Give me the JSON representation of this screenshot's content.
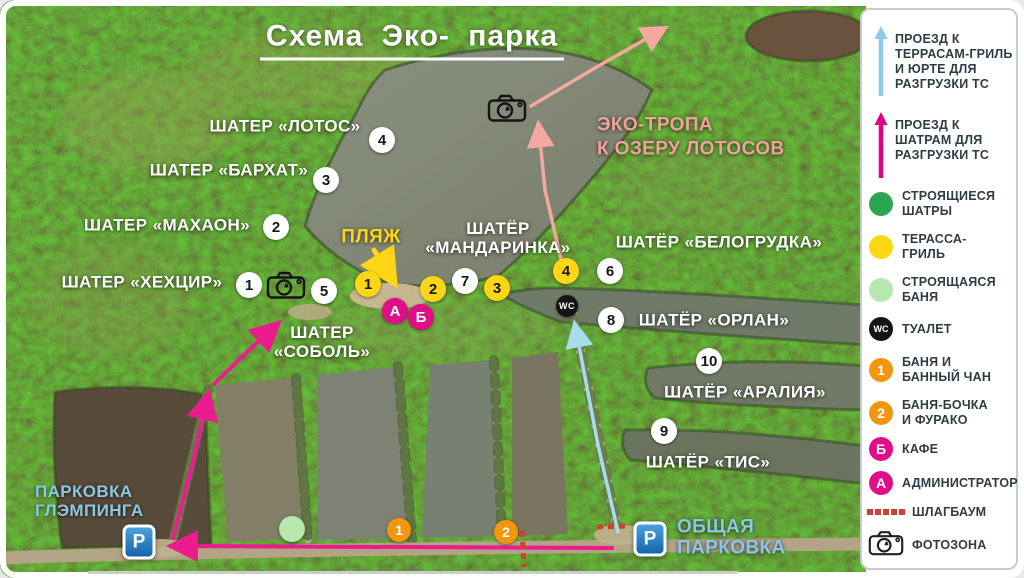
{
  "title": "Схема Эко- парка",
  "colors": {
    "label_white": "#ffffff",
    "label_yellow": "#ffd616",
    "label_salmon": "#f2a29c",
    "label_blue": "#8cc8e4",
    "route_magenta": "#ea1c8e",
    "route_cyan": "#a6dcec",
    "route_salmon": "#f4a8a0",
    "route_yellow": "#ffd616",
    "barrier_red": "#d0402e",
    "marker_yellow": "#ffd616",
    "marker_orange": "#f2960d",
    "marker_magenta": "#e00f87",
    "marker_green": "#2aa74e",
    "marker_lightgreen": "#b6e7ae"
  },
  "map": {
    "labels": [
      {
        "id": "lotos",
        "lines": [
          "ШАТЕР «ЛОТОС»"
        ],
        "x": 285,
        "y": 126,
        "size": 17,
        "color": "#ffffff",
        "align": "center"
      },
      {
        "id": "barhat",
        "lines": [
          "ШАТЕР «БАРХАТ»"
        ],
        "x": 229,
        "y": 170,
        "size": 17,
        "color": "#ffffff",
        "align": "center"
      },
      {
        "id": "mahaon",
        "lines": [
          "ШАТЕР «МАХАОН»"
        ],
        "x": 167,
        "y": 225,
        "size": 17,
        "color": "#ffffff",
        "align": "center"
      },
      {
        "id": "hehcir",
        "lines": [
          "ШАТЕР «ХЕХЦИР»"
        ],
        "x": 142,
        "y": 282,
        "size": 17,
        "color": "#ffffff",
        "align": "center"
      },
      {
        "id": "sobol",
        "lines": [
          "ШАТЕР",
          "«СОБОЛЬ»"
        ],
        "x": 322,
        "y": 342,
        "size": 17,
        "color": "#ffffff",
        "align": "center"
      },
      {
        "id": "plyazh",
        "lines": [
          "ПЛЯЖ"
        ],
        "x": 371,
        "y": 237,
        "size": 19,
        "color": "#ffd616",
        "align": "center"
      },
      {
        "id": "mandarinka",
        "lines": [
          "ШАТЁР",
          "«МАНДАРИНКА»"
        ],
        "x": 498,
        "y": 238,
        "size": 17,
        "color": "#ffffff",
        "align": "center"
      },
      {
        "id": "belogrudka",
        "lines": [
          "ШАТЁР «БЕЛОГРУДКА»"
        ],
        "x": 719,
        "y": 242,
        "size": 17,
        "color": "#ffffff",
        "align": "center"
      },
      {
        "id": "orlan",
        "lines": [
          "ШАТЁР «ОРЛАН»"
        ],
        "x": 714,
        "y": 320,
        "size": 17,
        "color": "#ffffff",
        "align": "center"
      },
      {
        "id": "araliya",
        "lines": [
          "ШАТЁР «АРАЛИЯ»"
        ],
        "x": 745,
        "y": 392,
        "size": 17,
        "color": "#ffffff",
        "align": "center"
      },
      {
        "id": "tis",
        "lines": [
          "ШАТЁР «ТИС»"
        ],
        "x": 708,
        "y": 462,
        "size": 17,
        "color": "#ffffff",
        "align": "center"
      },
      {
        "id": "eco-trail",
        "lines": [
          "ЭКО-ТРОПА",
          "К ОЗЕРУ ЛОТОСОВ"
        ],
        "x": 597,
        "y": 137,
        "size": 19,
        "color": "#f2a29c",
        "align": "left"
      },
      {
        "id": "glamping-parking",
        "lines": [
          "ПАРКОВКА",
          "ГЛЭМПИНГА"
        ],
        "x": 35,
        "y": 501,
        "size": 17,
        "color": "#8cc8e4",
        "align": "left"
      },
      {
        "id": "public-parking",
        "lines": [
          "ОБЩАЯ",
          "ПАРКОВКА"
        ],
        "x": 677,
        "y": 538,
        "size": 19,
        "color": "#8cc8e4",
        "align": "left"
      }
    ],
    "markers": [
      {
        "type": "white",
        "label": "4",
        "x": 382,
        "y": 140
      },
      {
        "type": "white",
        "label": "3",
        "x": 326,
        "y": 180
      },
      {
        "type": "white",
        "label": "2",
        "x": 276,
        "y": 227
      },
      {
        "type": "white",
        "label": "1",
        "x": 249,
        "y": 285
      },
      {
        "type": "white",
        "label": "5",
        "x": 324,
        "y": 291
      },
      {
        "type": "white",
        "label": "7",
        "x": 465,
        "y": 281
      },
      {
        "type": "white",
        "label": "6",
        "x": 610,
        "y": 271
      },
      {
        "type": "white",
        "label": "8",
        "x": 611,
        "y": 320
      },
      {
        "type": "white",
        "label": "10",
        "x": 709,
        "y": 361
      },
      {
        "type": "white",
        "label": "9",
        "x": 664,
        "y": 431
      },
      {
        "type": "yellow",
        "label": "1",
        "x": 368,
        "y": 284
      },
      {
        "type": "yellow",
        "label": "2",
        "x": 433,
        "y": 289
      },
      {
        "type": "yellow",
        "label": "3",
        "x": 497,
        "y": 288
      },
      {
        "type": "yellow",
        "label": "4",
        "x": 566,
        "y": 271
      },
      {
        "type": "magenta",
        "label": "А",
        "x": 395,
        "y": 311
      },
      {
        "type": "magenta",
        "label": "Б",
        "x": 421,
        "y": 317
      },
      {
        "type": "wc",
        "label": "WC",
        "x": 567,
        "y": 306
      },
      {
        "type": "orange",
        "label": "1",
        "x": 399,
        "y": 530
      },
      {
        "type": "orange",
        "label": "2",
        "x": 506,
        "y": 532
      },
      {
        "type": "greenlight",
        "label": "",
        "x": 292,
        "y": 529
      }
    ],
    "icons": [
      {
        "type": "camera",
        "x": 286,
        "y": 287
      },
      {
        "type": "camera",
        "x": 507,
        "y": 110
      },
      {
        "type": "parking",
        "x": 139,
        "y": 542
      },
      {
        "type": "parking",
        "x": 650,
        "y": 539
      }
    ],
    "routes": [
      {
        "name": "road-to-glamping-parking",
        "color": "#ea1c8e",
        "width": 4,
        "points": [
          [
            612,
            548
          ],
          [
            178,
            546
          ]
        ]
      },
      {
        "name": "road-up-dam",
        "color": "#ea1c8e",
        "width": 4,
        "points": [
          [
            173,
            538
          ],
          [
            193,
            462
          ],
          [
            207,
            400
          ]
        ]
      },
      {
        "name": "road-to-sobol",
        "color": "#ea1c8e",
        "width": 4,
        "points": [
          [
            214,
            384
          ],
          [
            247,
            352
          ],
          [
            273,
            328
          ]
        ]
      },
      {
        "name": "drive-to-terraces",
        "color": "#a6dcec",
        "width": 3.5,
        "points": [
          [
            618,
            532
          ],
          [
            598,
            445
          ],
          [
            576,
            330
          ]
        ]
      },
      {
        "name": "eco-trail-lower",
        "color": "#f4a8a0",
        "width": 3.5,
        "points": [
          [
            563,
            268
          ],
          [
            545,
            190
          ],
          [
            539,
            130
          ]
        ]
      },
      {
        "name": "eco-trail-upper",
        "color": "#f4a8a0",
        "width": 3.5,
        "points": [
          [
            531,
            106
          ],
          [
            595,
            68
          ],
          [
            660,
            31
          ]
        ]
      },
      {
        "name": "beach-pointer",
        "color": "#ffd616",
        "width": 5,
        "points": [
          [
            374,
            250
          ],
          [
            390,
            276
          ]
        ]
      }
    ],
    "barriers": [
      {
        "name": "barrier-1",
        "points": [
          [
            522,
            531
          ],
          [
            524,
            567
          ]
        ]
      },
      {
        "name": "barrier-2",
        "points": [
          [
            597,
            527
          ],
          [
            628,
            526
          ]
        ]
      }
    ]
  },
  "legend": {
    "items": [
      {
        "kind": "arrow",
        "color": "#8ecbe8",
        "y": 58,
        "span": [
          24,
          94
        ],
        "lines": [
          "ПРОЕЗД К",
          "ТЕРРАСАМ-ГРИЛЬ",
          "И ЮРТЕ ДЛЯ",
          "РАЗГРУЗКИ ТС"
        ],
        "name": "drive-to-grill-terraces"
      },
      {
        "kind": "arrow",
        "color": "#e0008c",
        "y": 142,
        "span": [
          110,
          176
        ],
        "lines": [
          "ПРОЕЗД К",
          "ШАТРАМ ДЛЯ",
          "РАЗГРУЗКИ ТС"
        ],
        "name": "drive-to-tents"
      },
      {
        "kind": "circle",
        "color": "#2aa74e",
        "y": 202,
        "lines": [
          "СТРОЯЩИЕСЯ",
          "ШАТРЫ"
        ],
        "name": "tents-under-construction"
      },
      {
        "kind": "circle",
        "color": "#ffd616",
        "y": 245,
        "lines": [
          "ТЕРАССА-",
          "ГРИЛЬ"
        ],
        "name": "grill-terrace"
      },
      {
        "kind": "circle",
        "color": "#b6e7ae",
        "y": 288,
        "lines": [
          "СТРОЯЩАЯСЯ",
          "БАНЯ"
        ],
        "name": "sauna-under-construction"
      },
      {
        "kind": "circle",
        "color": "#141414",
        "text": "WC",
        "textColor": "#ffffff",
        "textSize": 9,
        "y": 327,
        "lines": [
          "ТУАЛЕТ"
        ],
        "name": "toilet"
      },
      {
        "kind": "circle",
        "color": "#f2960d",
        "text": "1",
        "textColor": "#ffffff",
        "textSize": 14,
        "y": 368,
        "lines": [
          "БАНЯ И",
          "БАННЫЙ ЧАН"
        ],
        "name": "sauna-and-tub"
      },
      {
        "kind": "circle",
        "color": "#f2960d",
        "text": "2",
        "textColor": "#ffffff",
        "textSize": 14,
        "y": 411,
        "lines": [
          "БАНЯ-БОЧКА",
          "И ФУРАКО"
        ],
        "name": "barrel-sauna-furako"
      },
      {
        "kind": "circle",
        "color": "#e00f87",
        "text": "Б",
        "textColor": "#ffffff",
        "textSize": 14,
        "y": 447,
        "lines": [
          "КАФЕ"
        ],
        "name": "cafe"
      },
      {
        "kind": "circle",
        "color": "#e00f87",
        "text": "А",
        "textColor": "#ffffff",
        "textSize": 14,
        "y": 481,
        "lines": [
          "АДМИНИСТРАТОР"
        ],
        "name": "administrator"
      },
      {
        "kind": "dash",
        "color": "#d0402e",
        "y": 510,
        "lines": [
          "ШЛАГБАУМ"
        ],
        "name": "barrier-gate"
      },
      {
        "kind": "camera",
        "y": 543,
        "lines": [
          "ФОТОЗОНА"
        ],
        "name": "photo-zone"
      }
    ]
  }
}
